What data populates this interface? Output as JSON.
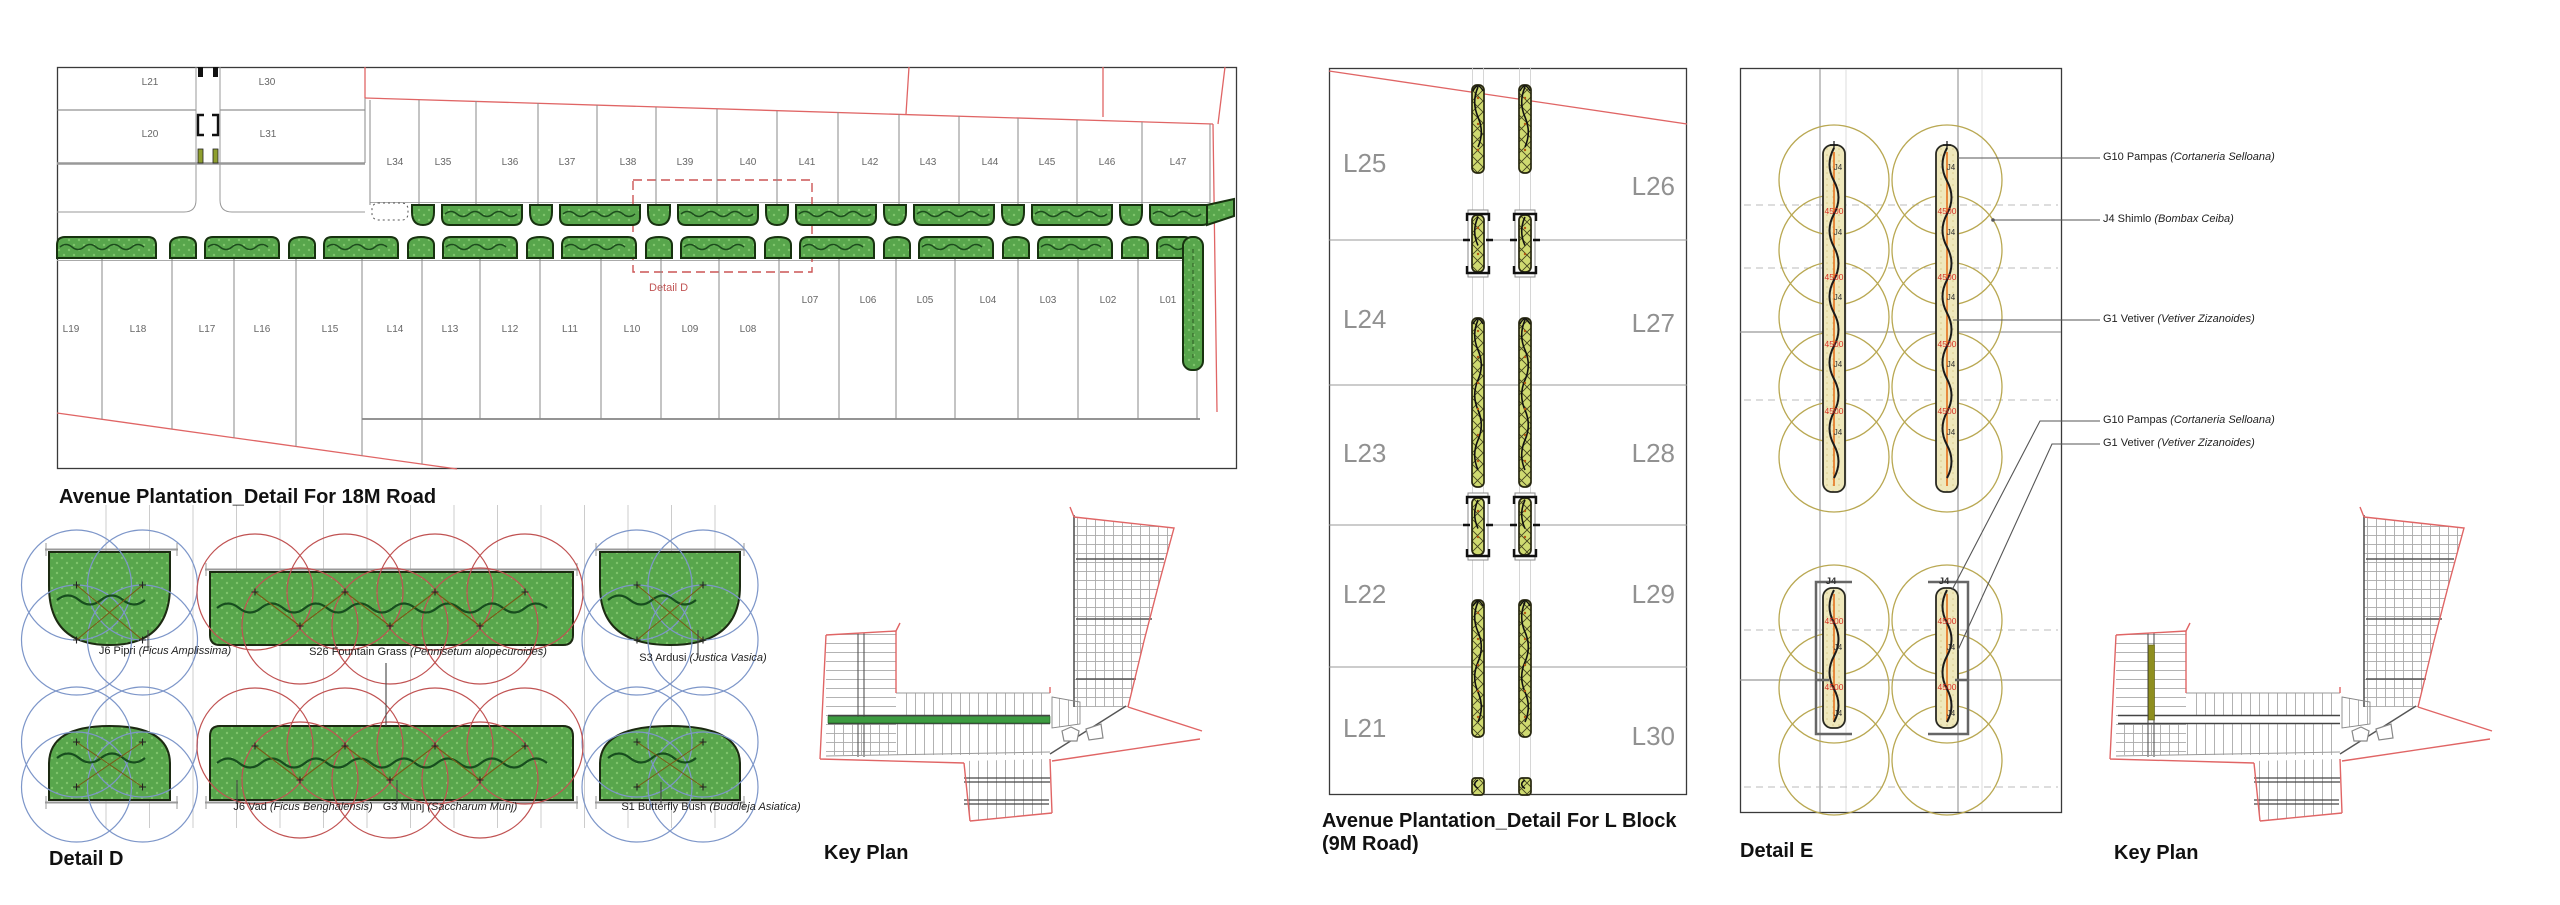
{
  "titles": {
    "road18m": "Avenue Plantation_Detail For 18M Road",
    "detail_d": "Detail D",
    "key_plan_left": "Key Plan",
    "l_block_line1": "Avenue Plantation_Detail For L Block",
    "l_block_line2": "(9M Road)",
    "detail_e": "Detail E",
    "key_plan_right": "Key Plan"
  },
  "road18m": {
    "detail_box_label": "Detail D",
    "corner_lots": [
      "L21",
      "L30",
      "L20",
      "L31"
    ],
    "top_lots": [
      "L34",
      "L35",
      "L36",
      "L37",
      "L38",
      "L39",
      "L40",
      "L41",
      "L42",
      "L43",
      "L44",
      "L45",
      "L46",
      "L47"
    ],
    "bottom_lots_left": [
      "L19",
      "L18",
      "L17",
      "L16",
      "L15",
      "L14",
      "L13",
      "L12",
      "L11",
      "L10",
      "L09",
      "L08"
    ],
    "bottom_lots_right": [
      "L07",
      "L06",
      "L05",
      "L04",
      "L03",
      "L02",
      "L01"
    ]
  },
  "detail_d": {
    "row1_labels": [
      {
        "name": "J6 Pipri",
        "latin": "(Ficus Amplissima)"
      },
      {
        "name": "S26 Fountain Grass",
        "latin": "(Pennisetum alopecuroides)"
      },
      {
        "name": "S3 Ardusi",
        "latin": "(Justica Vasica)"
      }
    ],
    "row2_labels": [
      {
        "name": "J6 Vad",
        "latin": "(Ficus Benghalensis)"
      },
      {
        "name": "G3 Munj",
        "latin": "(Saccharum Munj)"
      },
      {
        "name": "S1 Butterfly Bush",
        "latin": "(Buddleja Asiatica)"
      }
    ]
  },
  "l_block": {
    "left_lots": [
      "L25",
      "L24",
      "L23",
      "L22",
      "L21"
    ],
    "right_lots": [
      "L26",
      "L27",
      "L28",
      "L29",
      "L30"
    ]
  },
  "detail_e": {
    "labels": [
      {
        "name": "G10 Pampas",
        "latin": "(Cortaneria Selloana)"
      },
      {
        "name": "J4 Shimlo",
        "latin": "(Bombax Ceiba)"
      },
      {
        "name": "G1 Vetiver",
        "latin": "(Vetiver Zizanoides)"
      },
      {
        "name": "G10 Pampas",
        "latin": "(Cortaneria Selloana)"
      },
      {
        "name": "G1 Vetiver",
        "latin": "(Vetiver Zizanoides)"
      }
    ],
    "dim_text": "4500",
    "tree_tag": "J4"
  },
  "colors": {
    "plan_green": "#58a64c",
    "strip_yellow": "#cfda71",
    "pale_yellow": "#efe8bc",
    "red_line": "#e06565",
    "olive_circle": "#b9a852",
    "highlight_green": "#3d9c41",
    "highlight_olive": "#8f8f1f"
  }
}
